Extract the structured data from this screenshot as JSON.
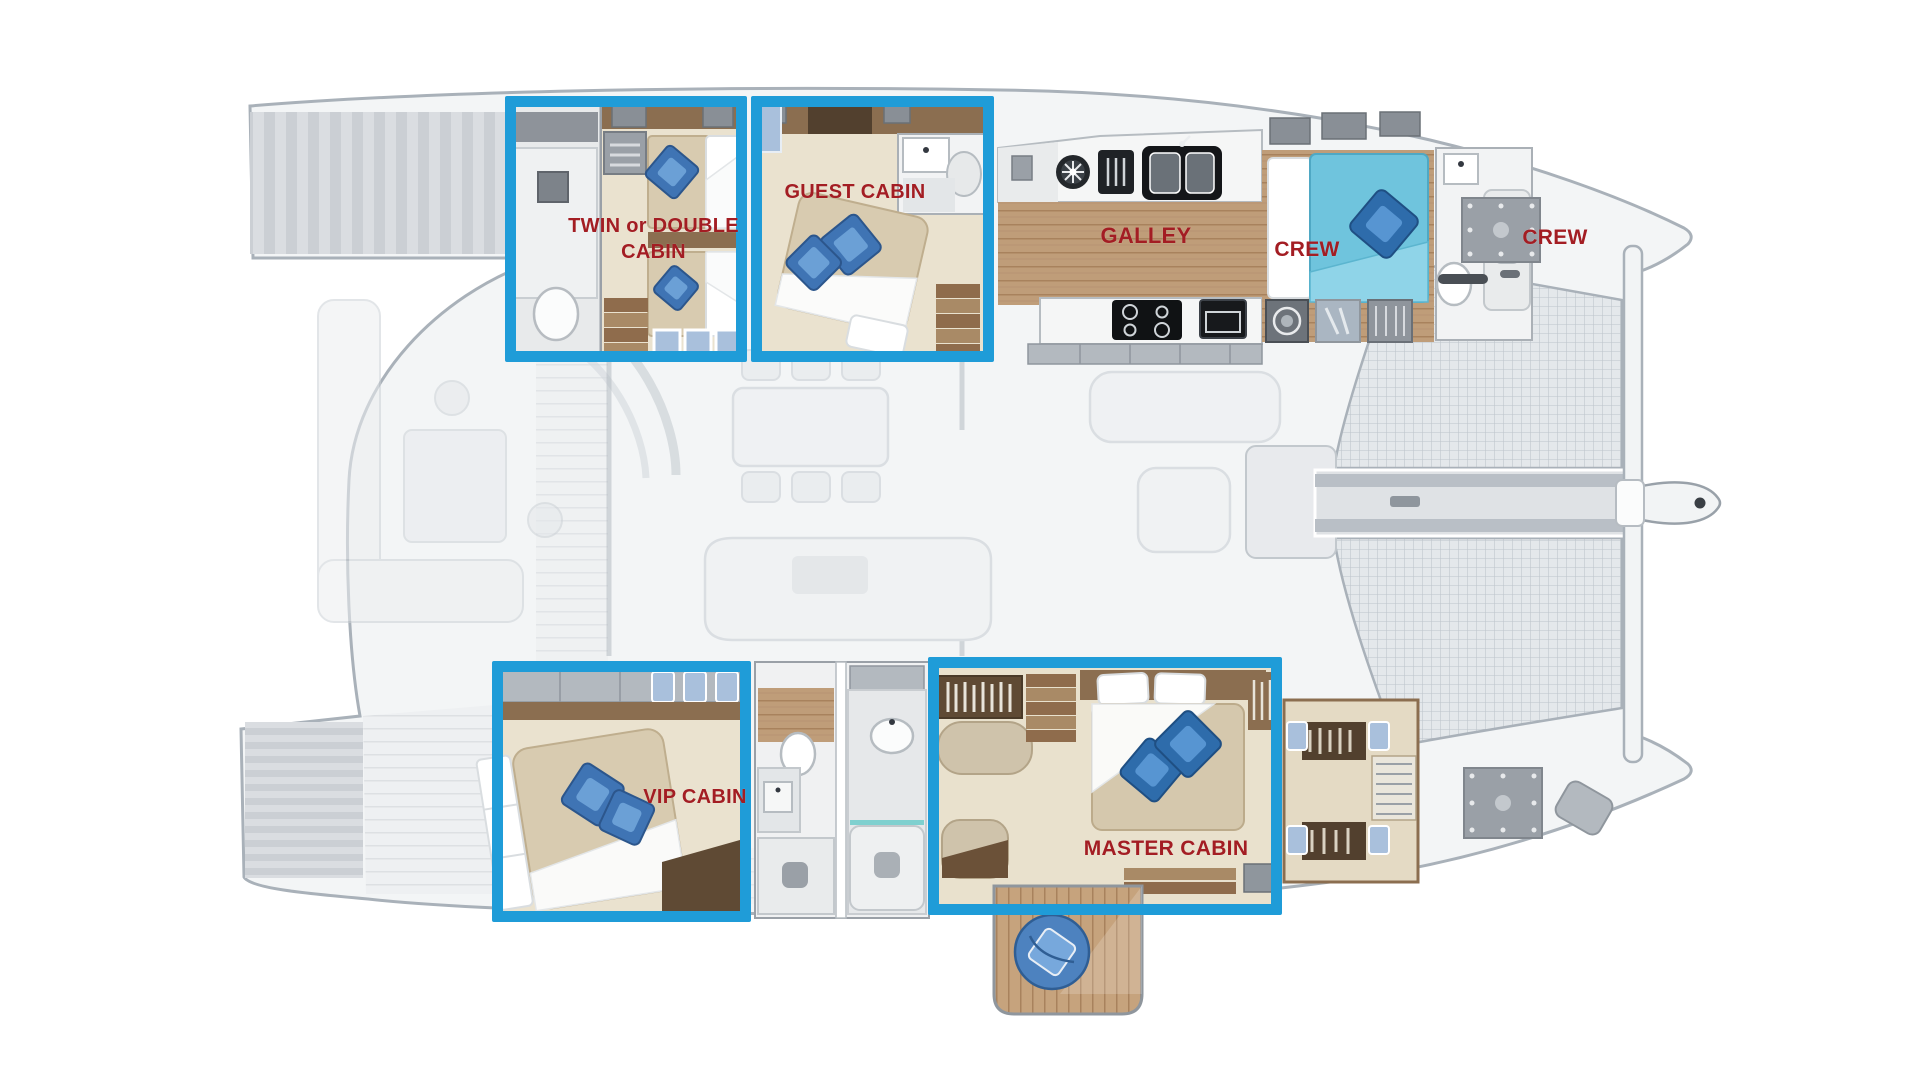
{
  "diagram": {
    "type": "catamaran-deck-plan",
    "colors": {
      "highlight_blue": "#1f9cd8",
      "label_red": "#a31d23",
      "hull_gray": "#f2f4f6",
      "floor_beige": "#eae2cf",
      "wood_brown": "#8b6e50",
      "galley_floor": "#bf9d79",
      "bed_teal": "#6fc4dd",
      "pillow_blue": "#3f74b4"
    },
    "rooms": [
      {
        "id": "twin-or-double-cabin",
        "label": "TWIN or DOUBLE CABIN",
        "highlighted": true
      },
      {
        "id": "guest-cabin",
        "label": "GUEST CABIN",
        "highlighted": true
      },
      {
        "id": "galley",
        "label": "GALLEY",
        "highlighted": false
      },
      {
        "id": "crew-cabin",
        "label": "CREW",
        "highlighted": false
      },
      {
        "id": "crew-bow-area",
        "label": "CREW",
        "highlighted": false
      },
      {
        "id": "vip-cabin",
        "label": "VIP CABIN",
        "highlighted": true
      },
      {
        "id": "master-cabin",
        "label": "MASTER CABIN",
        "highlighted": true
      }
    ]
  }
}
